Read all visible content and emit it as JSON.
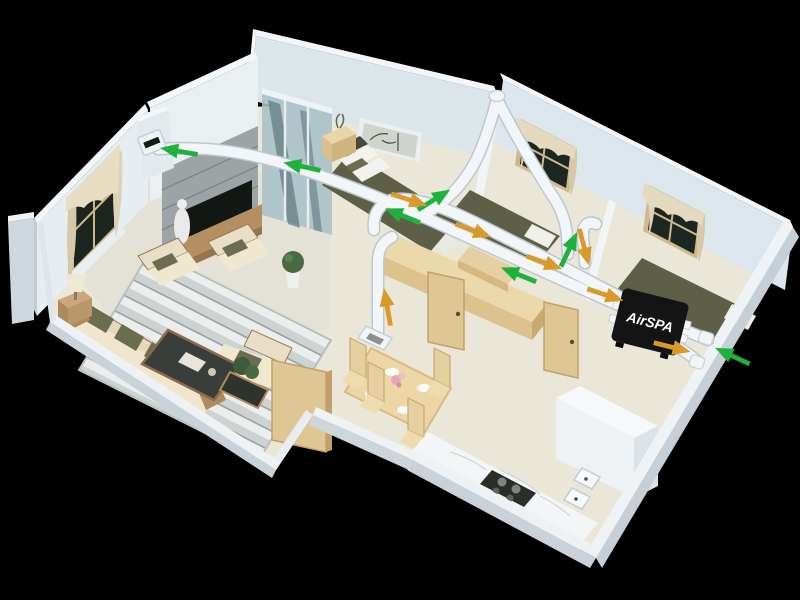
{
  "scene": {
    "type": "3d-isometric-apartment-cutaway",
    "background_color": "#000000",
    "description": "3D cutaway floor plan of an apartment with a ducted fresh-air ventilation system"
  },
  "ventilation_unit": {
    "label": "AirSPA",
    "body_color": "#141414",
    "label_color": "#ffffff"
  },
  "airflow": {
    "duct_color": "#f3f6f8",
    "duct_shadow_color": "#bcc8d0",
    "supply_arrow_color": "#1fb13e",
    "exhaust_arrow_color": "#d9992b",
    "arrows": [
      {
        "id": "supply-to-living-grille",
        "type": "supply",
        "x": 172,
        "y": 150,
        "angle": 190
      },
      {
        "id": "supply-over-master",
        "type": "supply",
        "x": 295,
        "y": 165,
        "angle": 192
      },
      {
        "id": "supply-over-master-2",
        "type": "supply",
        "x": 396,
        "y": 213,
        "angle": 202
      },
      {
        "id": "supply-hallway-trunk",
        "type": "supply",
        "x": 512,
        "y": 272,
        "angle": 202
      },
      {
        "id": "supply-riser-bedroom2",
        "type": "supply",
        "x": 440,
        "y": 196,
        "angle": -32
      },
      {
        "id": "supply-drop-bedroom2",
        "type": "supply",
        "x": 572,
        "y": 243,
        "angle": -65
      },
      {
        "id": "supply-outdoor-intake",
        "type": "supply",
        "x": 726,
        "y": 353,
        "angle": 205
      },
      {
        "id": "return-master",
        "type": "exhaust",
        "x": 416,
        "y": 202,
        "angle": 18
      },
      {
        "id": "return-hallway-1",
        "type": "exhaust",
        "x": 480,
        "y": 233,
        "angle": 20
      },
      {
        "id": "return-hallway-2",
        "type": "exhaust",
        "x": 551,
        "y": 265,
        "angle": 20
      },
      {
        "id": "return-drop-bedroom2",
        "type": "exhaust",
        "x": 586,
        "y": 254,
        "angle": 75
      },
      {
        "id": "return-into-unit",
        "type": "exhaust",
        "x": 612,
        "y": 297,
        "angle": 18
      },
      {
        "id": "exhaust-outdoor",
        "type": "exhaust",
        "x": 679,
        "y": 349,
        "angle": 14
      },
      {
        "id": "return-floor-diffuser",
        "type": "exhaust",
        "x": 386,
        "y": 300,
        "angle": -100
      }
    ]
  },
  "rooms": [
    {
      "name": "living-room"
    },
    {
      "name": "master-bedroom"
    },
    {
      "name": "bedroom-middle"
    },
    {
      "name": "bedroom-right"
    },
    {
      "name": "hallway"
    },
    {
      "name": "dining-area"
    },
    {
      "name": "kitchen"
    },
    {
      "name": "balcony"
    }
  ],
  "palette": {
    "wall_light": "#e9eef2",
    "wall_shadow": "#cfd9e0",
    "wall_top": "#f4f7f9",
    "floor_cream": "#eae7d9",
    "wood_light": "#e2cb9c",
    "bedding_olive": "#5d5f46",
    "sofa_beige": "#e8dfc6",
    "rug_gray": "#cdd2d3",
    "stone_gray": "#9da4a6",
    "glass_teal": "#a7c0c7",
    "marble_white": "#f3f5f7"
  }
}
